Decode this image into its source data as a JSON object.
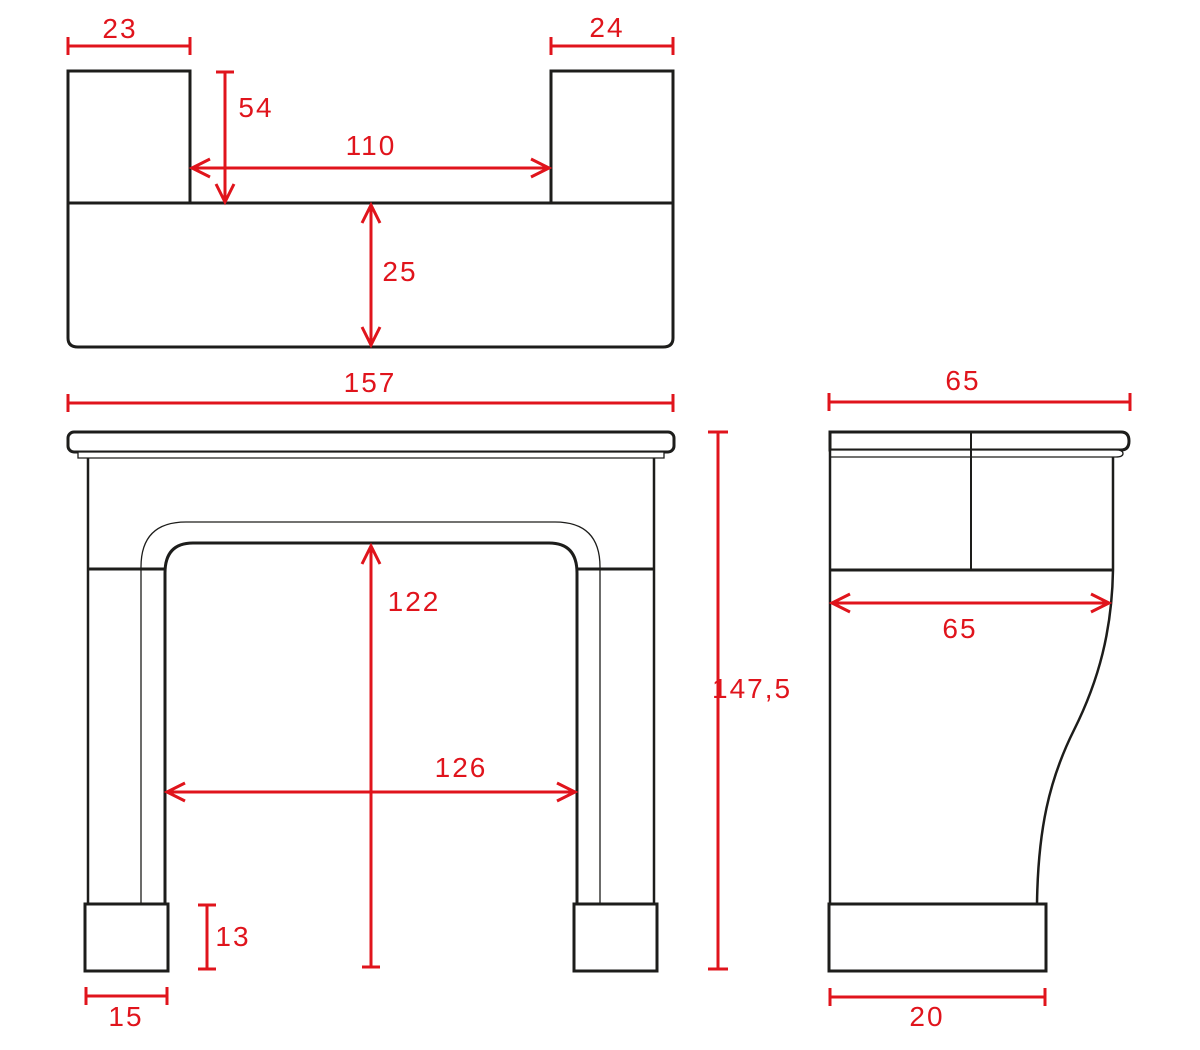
{
  "drawing": {
    "subject": "fireplace-mantel-dimension-drawing",
    "colors": {
      "dimension_red": "#e0141c",
      "outline_black": "#1d1d1b",
      "background": "#ffffff"
    }
  },
  "dims": {
    "top_left_block_width": "23",
    "top_right_block_width": "24",
    "top_block_depth": "54",
    "top_between_blocks": "110",
    "top_shelf_depth": "25",
    "overall_width": "157",
    "opening_height": "122",
    "opening_width": "126",
    "overall_height": "147,5",
    "plinth_height": "13",
    "plinth_width": "15",
    "side_top_width": "65",
    "side_body_depth": "65",
    "side_plinth_width": "20"
  }
}
